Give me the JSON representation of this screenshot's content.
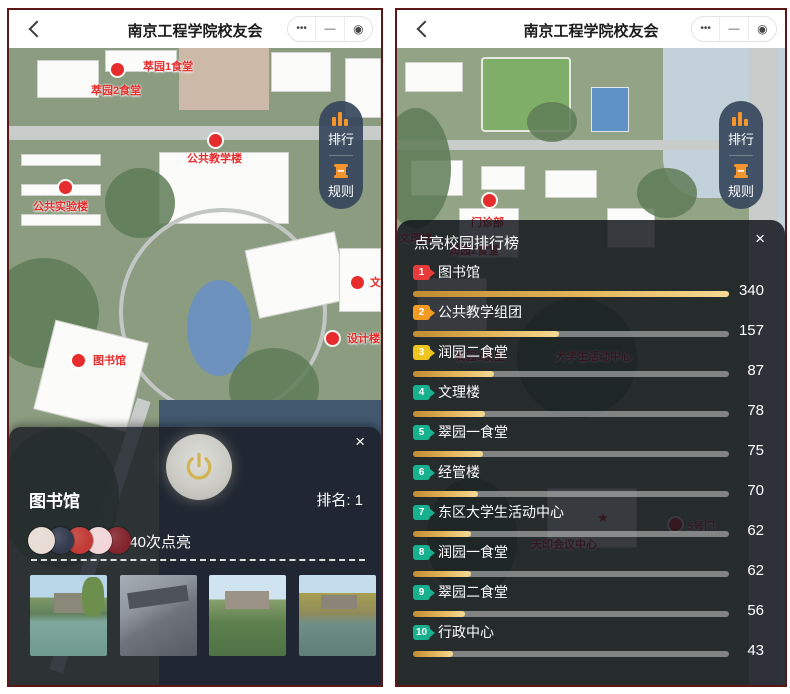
{
  "header": {
    "title": "南京工程学院校友会",
    "capsule": {
      "more": "•••",
      "minimize": "—",
      "close": "◉"
    }
  },
  "side_menu": {
    "rank_label": "排行",
    "rules_label": "规则"
  },
  "left_panel": {
    "map_labels": [
      {
        "text": "萃园1食堂"
      },
      {
        "text": "萃园2食堂"
      },
      {
        "text": "公共教学楼"
      },
      {
        "text": "公共实验楼"
      },
      {
        "text": "图书馆"
      },
      {
        "text": "设计楼"
      },
      {
        "text": "文理"
      }
    ],
    "detail_sheet": {
      "close_label": "×",
      "title": "图书馆",
      "rank_text": "排名: 1",
      "lights_text": "340次点亮",
      "avatar_colors": [
        "#e8dcd4",
        "#343a4e",
        "#c13a35",
        "#f2d6d9",
        "#83242c"
      ]
    }
  },
  "right_panel": {
    "map_labels": [
      {
        "text": "门诊部"
      },
      {
        "text": "润园2食堂"
      },
      {
        "text": "文理楼"
      },
      {
        "text": "润园1食堂"
      },
      {
        "text": "大学生活动中心"
      },
      {
        "text": "天印会议中心"
      },
      {
        "text": "5号门"
      },
      {
        "text": "★"
      }
    ],
    "leaderboard": {
      "title": "点亮校园排行榜",
      "close_label": "×",
      "max_value": 340,
      "bar_track_color": "#cdcdcd",
      "bar_fill_colors": [
        "#c08b33",
        "#f4d994"
      ],
      "items": [
        {
          "rank": "1",
          "name": "图书馆",
          "value": 340,
          "badge_color": "#e83c3c"
        },
        {
          "rank": "2",
          "name": "公共教学组团",
          "value": 157,
          "badge_color": "#f59b22"
        },
        {
          "rank": "3",
          "name": "润园二食堂",
          "value": 87,
          "badge_color": "#eec41d"
        },
        {
          "rank": "4",
          "name": "文理楼",
          "value": 78,
          "badge_color": "#17b18f"
        },
        {
          "rank": "5",
          "name": "翠园一食堂",
          "value": 75,
          "badge_color": "#17b18f"
        },
        {
          "rank": "6",
          "name": "经管楼",
          "value": 70,
          "badge_color": "#17b18f"
        },
        {
          "rank": "7",
          "name": "东区大学生活动中心",
          "value": 62,
          "badge_color": "#17b18f"
        },
        {
          "rank": "8",
          "name": "润园一食堂",
          "value": 62,
          "badge_color": "#17b18f"
        },
        {
          "rank": "9",
          "name": "翠园二食堂",
          "value": 56,
          "badge_color": "#17b18f"
        },
        {
          "rank": "10",
          "name": "行政中心",
          "value": 43,
          "badge_color": "#17b18f"
        }
      ]
    }
  }
}
